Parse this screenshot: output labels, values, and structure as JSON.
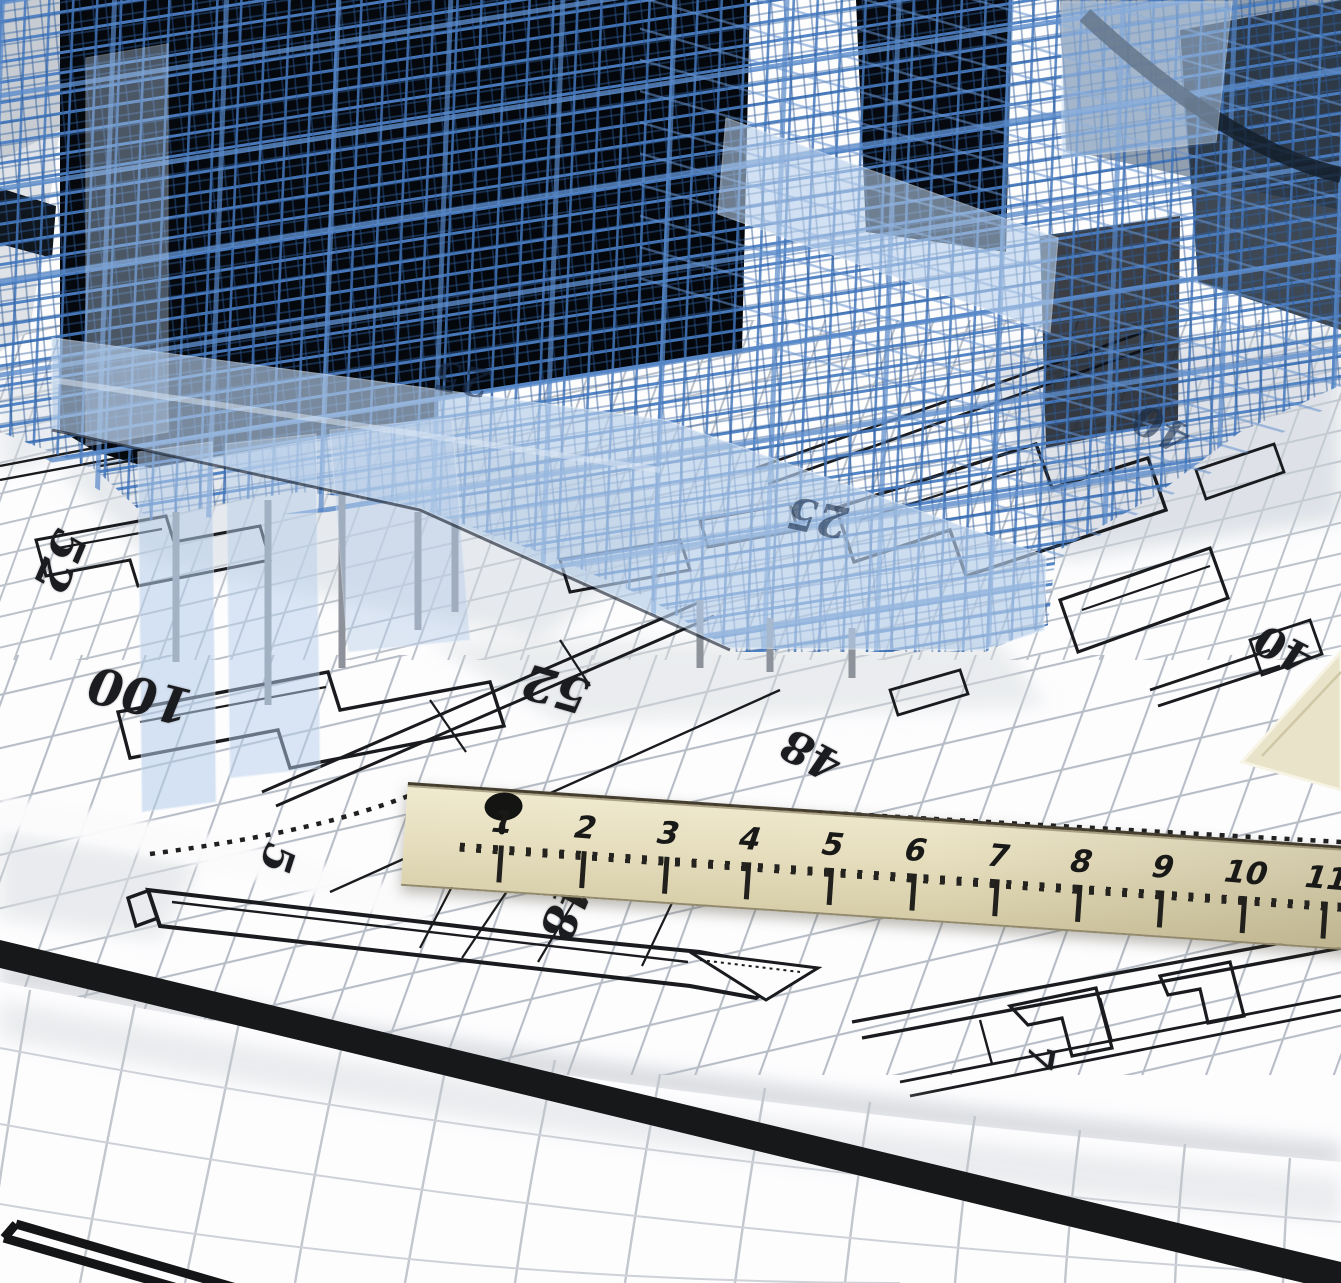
{
  "scene": {
    "description": "3D wireframe CAD building model standing on architectural blueprints with a wooden ruler and rolled plan sheet"
  },
  "palette": {
    "building_frame_blue": "#4b7ec2",
    "building_frame_dark_blue": "#2a5694",
    "building_glass_blue": "#b5cde9",
    "building_core_dark": "#05080d",
    "paper_white": "#fdfdfe",
    "grid_gray": "#b7bdc6",
    "plan_line_black": "#1a1b1e",
    "ruler_wood_light": "#f0ead0",
    "ruler_wood_dark": "#d2c8a2",
    "marking_black": "#1c1c1c"
  },
  "blueprint": {
    "dimension_labels": [
      "52",
      "100",
      "52",
      "48",
      "40",
      "5",
      "48",
      "7"
    ]
  },
  "building": {
    "glass_labels": [
      "25",
      "25",
      "40"
    ]
  },
  "ruler": {
    "numbers": [
      "1",
      "2",
      "3",
      "4",
      "5",
      "6",
      "7",
      "8",
      "9",
      "10"
    ],
    "edge_number": "11"
  }
}
